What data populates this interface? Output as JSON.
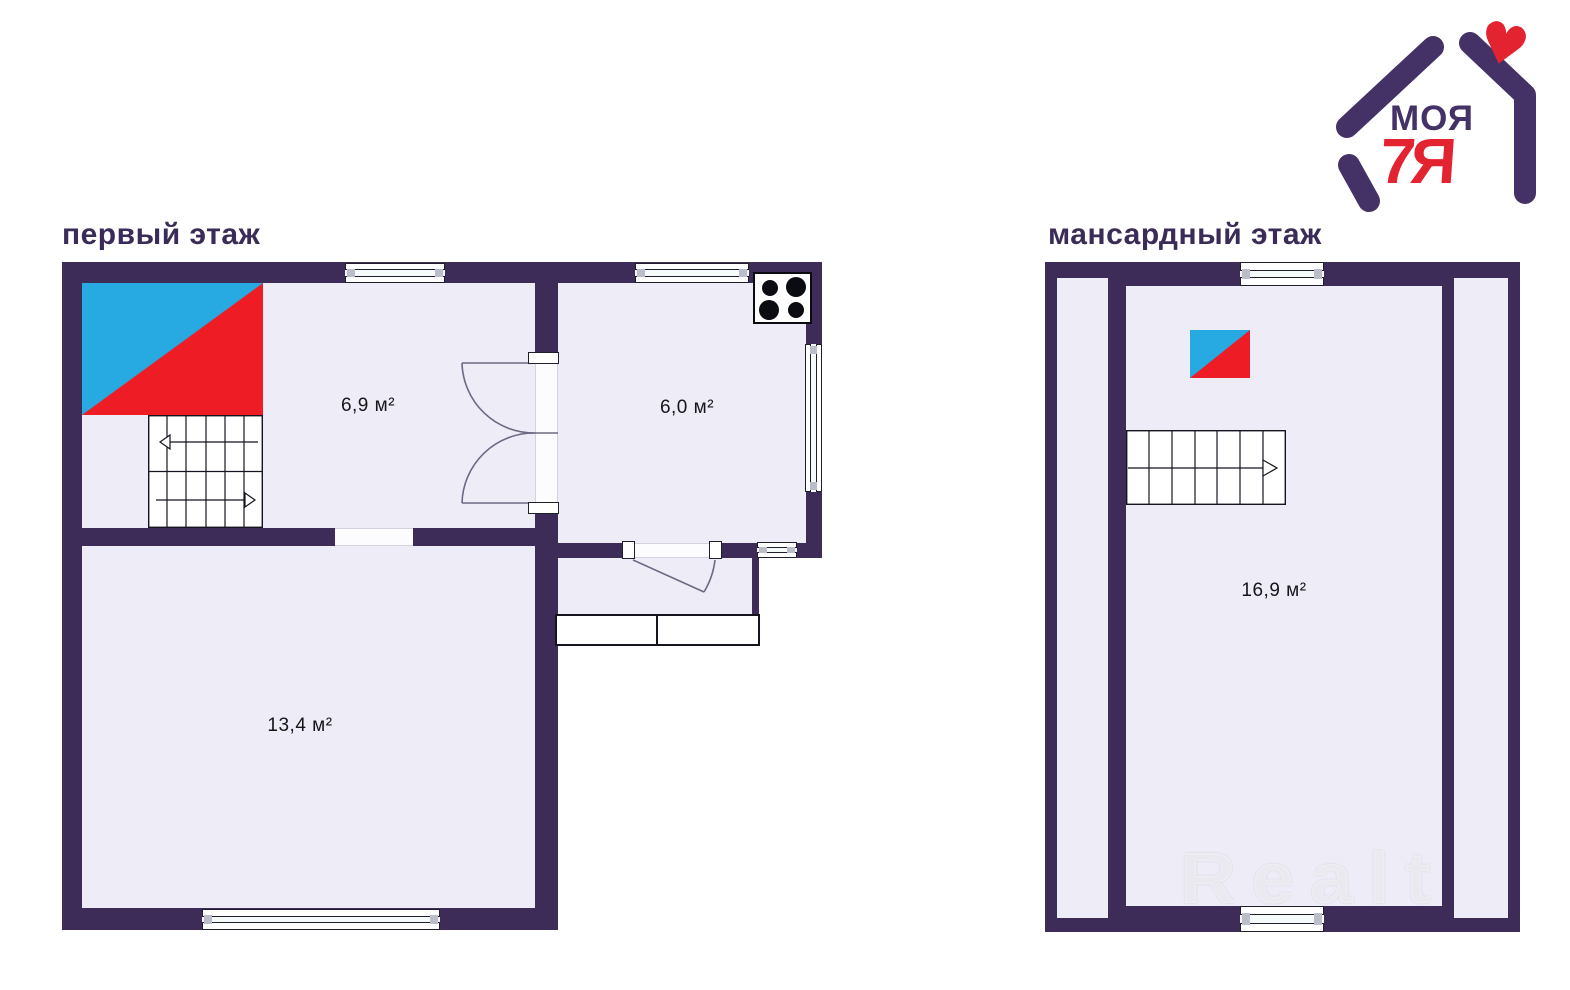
{
  "floor1": {
    "title": "первый этаж",
    "room_labels": [
      "6,9 м²",
      "6,0 м²",
      "13,4 м²"
    ]
  },
  "floor2": {
    "title": "мансардный этаж",
    "room_labels": [
      "16,9 м²"
    ]
  },
  "logo": {
    "word_top": "МОЯ",
    "word_bottom": "7Я",
    "heart_glyph": "♥"
  },
  "watermark": {
    "text": "Realt"
  },
  "colors": {
    "wall": "#3e2c58",
    "floor": "#eeedf7",
    "marker_blue": "#27aae1",
    "marker_red": "#ee1c25",
    "logo_purple": "#443266",
    "logo_red": "#e42330",
    "title_color": "#3a2b58"
  }
}
